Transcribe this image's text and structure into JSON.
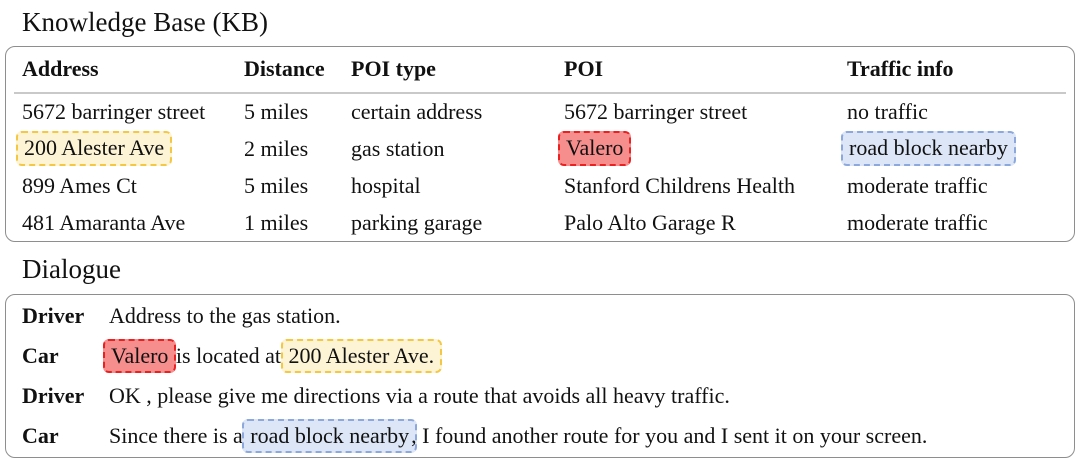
{
  "kb": {
    "title": "Knowledge Base (KB)",
    "columns": [
      "Address",
      "Distance",
      "POI type",
      "POI",
      "Traffic info"
    ],
    "rows": [
      {
        "cells": [
          "5672 barringer street",
          "5 miles",
          "certain address",
          "5672 barringer street",
          "no traffic"
        ],
        "highlights": [
          null,
          null,
          null,
          null,
          null
        ]
      },
      {
        "cells": [
          "200 Alester Ave",
          "2 miles",
          "gas station",
          "Valero",
          "road block nearby"
        ],
        "highlights": [
          "yellow",
          null,
          null,
          "red",
          "blue"
        ]
      },
      {
        "cells": [
          "899 Ames Ct",
          "5 miles",
          "hospital",
          "Stanford Childrens Health",
          "moderate traffic"
        ],
        "highlights": [
          null,
          null,
          null,
          null,
          null
        ]
      },
      {
        "cells": [
          "481 Amaranta Ave",
          "1 miles",
          "parking garage",
          "Palo Alto Garage R",
          "moderate traffic"
        ],
        "highlights": [
          null,
          null,
          null,
          null,
          null
        ]
      }
    ]
  },
  "dialogue": {
    "title": "Dialogue",
    "turns": [
      {
        "speaker": "Driver",
        "segments": [
          {
            "text": "Address to the gas station.",
            "highlight": null
          }
        ]
      },
      {
        "speaker": "Car",
        "segments": [
          {
            "text": "Valero",
            "highlight": "red"
          },
          {
            "text": " is located at ",
            "highlight": null
          },
          {
            "text": "200 Alester Ave.",
            "highlight": "yellow"
          }
        ]
      },
      {
        "speaker": "Driver",
        "segments": [
          {
            "text": "OK , please give me directions via a route that avoids all heavy traffic.",
            "highlight": null
          }
        ]
      },
      {
        "speaker": "Car",
        "segments": [
          {
            "text": "Since there is a ",
            "highlight": null
          },
          {
            "text": "road block nearby",
            "highlight": "blue"
          },
          {
            "text": ", I found another route for you and I sent it on your screen.",
            "highlight": null
          }
        ]
      }
    ]
  },
  "colors": {
    "page_bg": "#ffffff",
    "text": "#111111",
    "box_border": "#8e8e8e",
    "header_rule": "#c9c9c9",
    "yellow_bg": "#fdf4d6",
    "yellow_border": "#f5c843",
    "red_bg": "#f68e8e",
    "red_border": "#eb2121",
    "blue_bg": "#dce6f6",
    "blue_border": "#8ca8dc"
  }
}
